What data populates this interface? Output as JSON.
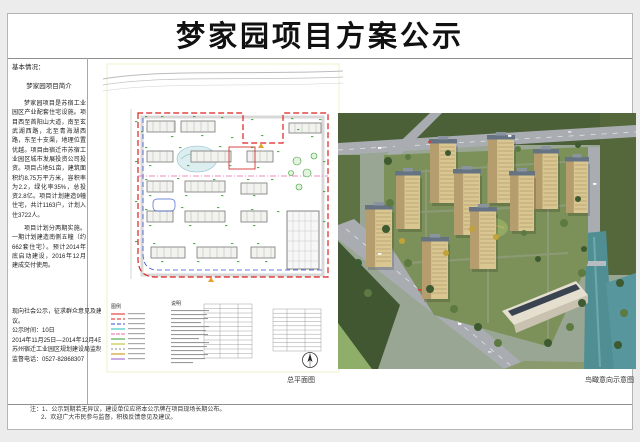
{
  "page": {
    "title": "梦家园项目方案公示"
  },
  "left_panel": {
    "section_label": "基本情况：",
    "intro_heading": "梦家园项目简介",
    "intro_p1": "梦家园项目是苏宿工业园区产业配套住宅设施。项目西至首阳山大道，南至玄武湖西路，北至青海湖西路，东至十支渠，地理位置优越。项目由宿迁市苏宿工业园区城市发展投资公司投资。项目占地51亩，建筑面积约8.75万平方米，容积率为2.2，绿化率35%，总投资2.8亿。项目计划建造9幢住宅，共计1163户，计划入住3722人。",
    "intro_p2": "项目计划分两期实施。一期计划建造南侧五幢（约662套住宅）。预计2014年底启动建设，2016年12月建成交付使用。",
    "notice_line1": "现向社会公示，征求群众意见及建议。",
    "notice_line2": "公示时间：10日",
    "notice_line3": "2014年11月25日—2014年12月4日",
    "notice_line4": "苏州宿迁工业园区规划建设局监制",
    "notice_line5": "监督电话：0527-82868307"
  },
  "site_plan": {
    "caption": "总平面图",
    "legend_title": "图例",
    "notes_title": "说明"
  },
  "render": {
    "caption": "鸟瞰意向示意图"
  },
  "footnotes": {
    "line1": "注：1、公示到期若无异议，建设单位应将本公示牌在项目现场长期公布。",
    "line2": "2、欢迎广大市民参与监督，积极反馈意见及建议。"
  },
  "palette": {
    "boundary_red": "#dd2222",
    "boundary_blue": "#3355cc",
    "phase_line_pink": "#ee66aa",
    "annotation_green": "#33a033",
    "building_tan": "#d9c690",
    "water_teal": "#4f8f94",
    "forest_green": "#4c6038",
    "road_gray": "#a9adb2"
  }
}
